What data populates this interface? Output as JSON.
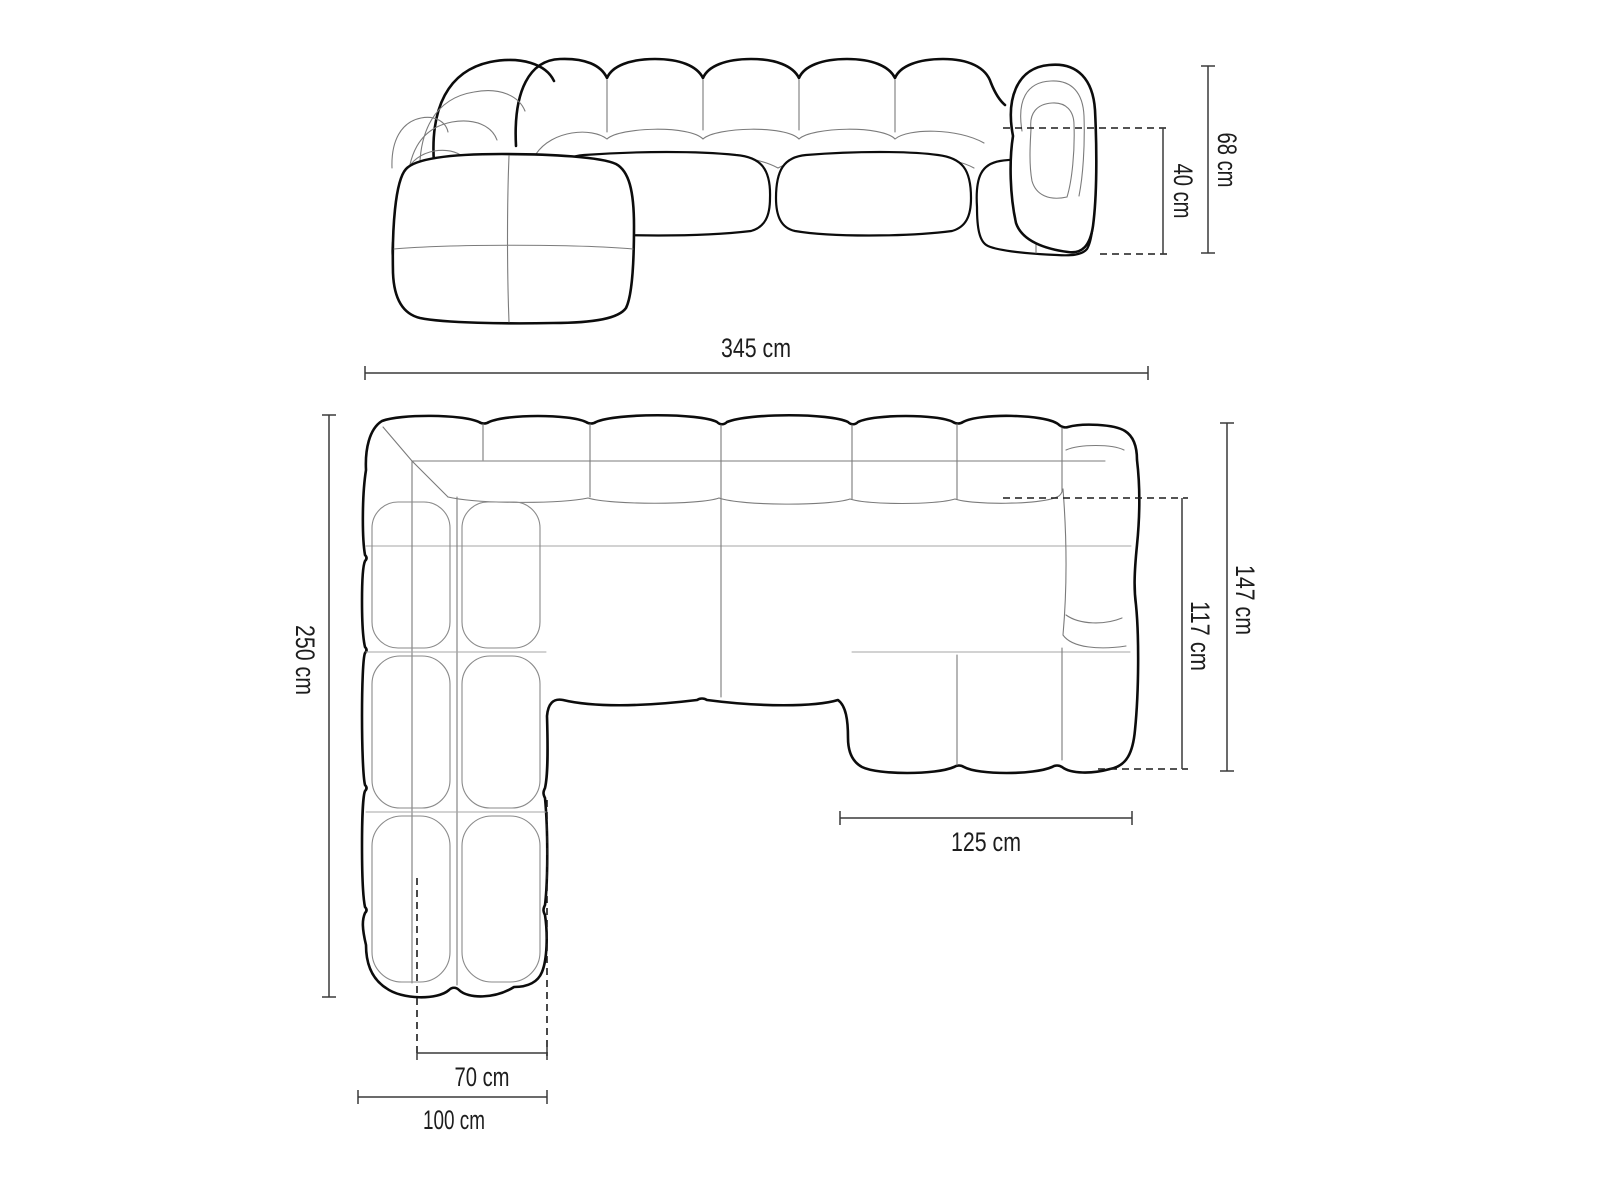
{
  "diagram": {
    "title": "sofa-dimensions-diagram",
    "background_color": "#ffffff",
    "outline_color": "#0c0c0c",
    "seam_color": "#7b7b7b",
    "dimension_line_color": "#3a3a3a",
    "text_color": "#1d1d1d"
  },
  "views": {
    "front_elevation": {
      "name": "sofa front elevation view"
    },
    "top_plan": {
      "name": "sofa top plan view"
    }
  },
  "dimensions": {
    "height_total": {
      "label": "68 cm",
      "value": 68,
      "unit": "cm",
      "orientation": "vertical",
      "view": "front_elevation"
    },
    "seat_height": {
      "label": "40 cm",
      "value": 40,
      "unit": "cm",
      "orientation": "vertical",
      "view": "front_elevation"
    },
    "width_total": {
      "label": "345 cm",
      "value": 345,
      "unit": "cm",
      "orientation": "horizontal",
      "view": "top_plan"
    },
    "depth_total": {
      "label": "250 cm",
      "value": 250,
      "unit": "cm",
      "orientation": "vertical",
      "view": "top_plan"
    },
    "right_depth": {
      "label": "147 cm",
      "value": 147,
      "unit": "cm",
      "orientation": "vertical",
      "view": "top_plan"
    },
    "right_depth_inner": {
      "label": "117 cm",
      "value": 117,
      "unit": "cm",
      "orientation": "vertical",
      "view": "top_plan"
    },
    "right_seat_width": {
      "label": "125 cm",
      "value": 125,
      "unit": "cm",
      "orientation": "horizontal",
      "view": "top_plan"
    },
    "chaise_seat_width": {
      "label": "70 cm",
      "value": 70,
      "unit": "cm",
      "orientation": "horizontal",
      "view": "top_plan"
    },
    "chaise_width": {
      "label": "100 cm",
      "value": 100,
      "unit": "cm",
      "orientation": "horizontal",
      "view": "top_plan"
    }
  }
}
